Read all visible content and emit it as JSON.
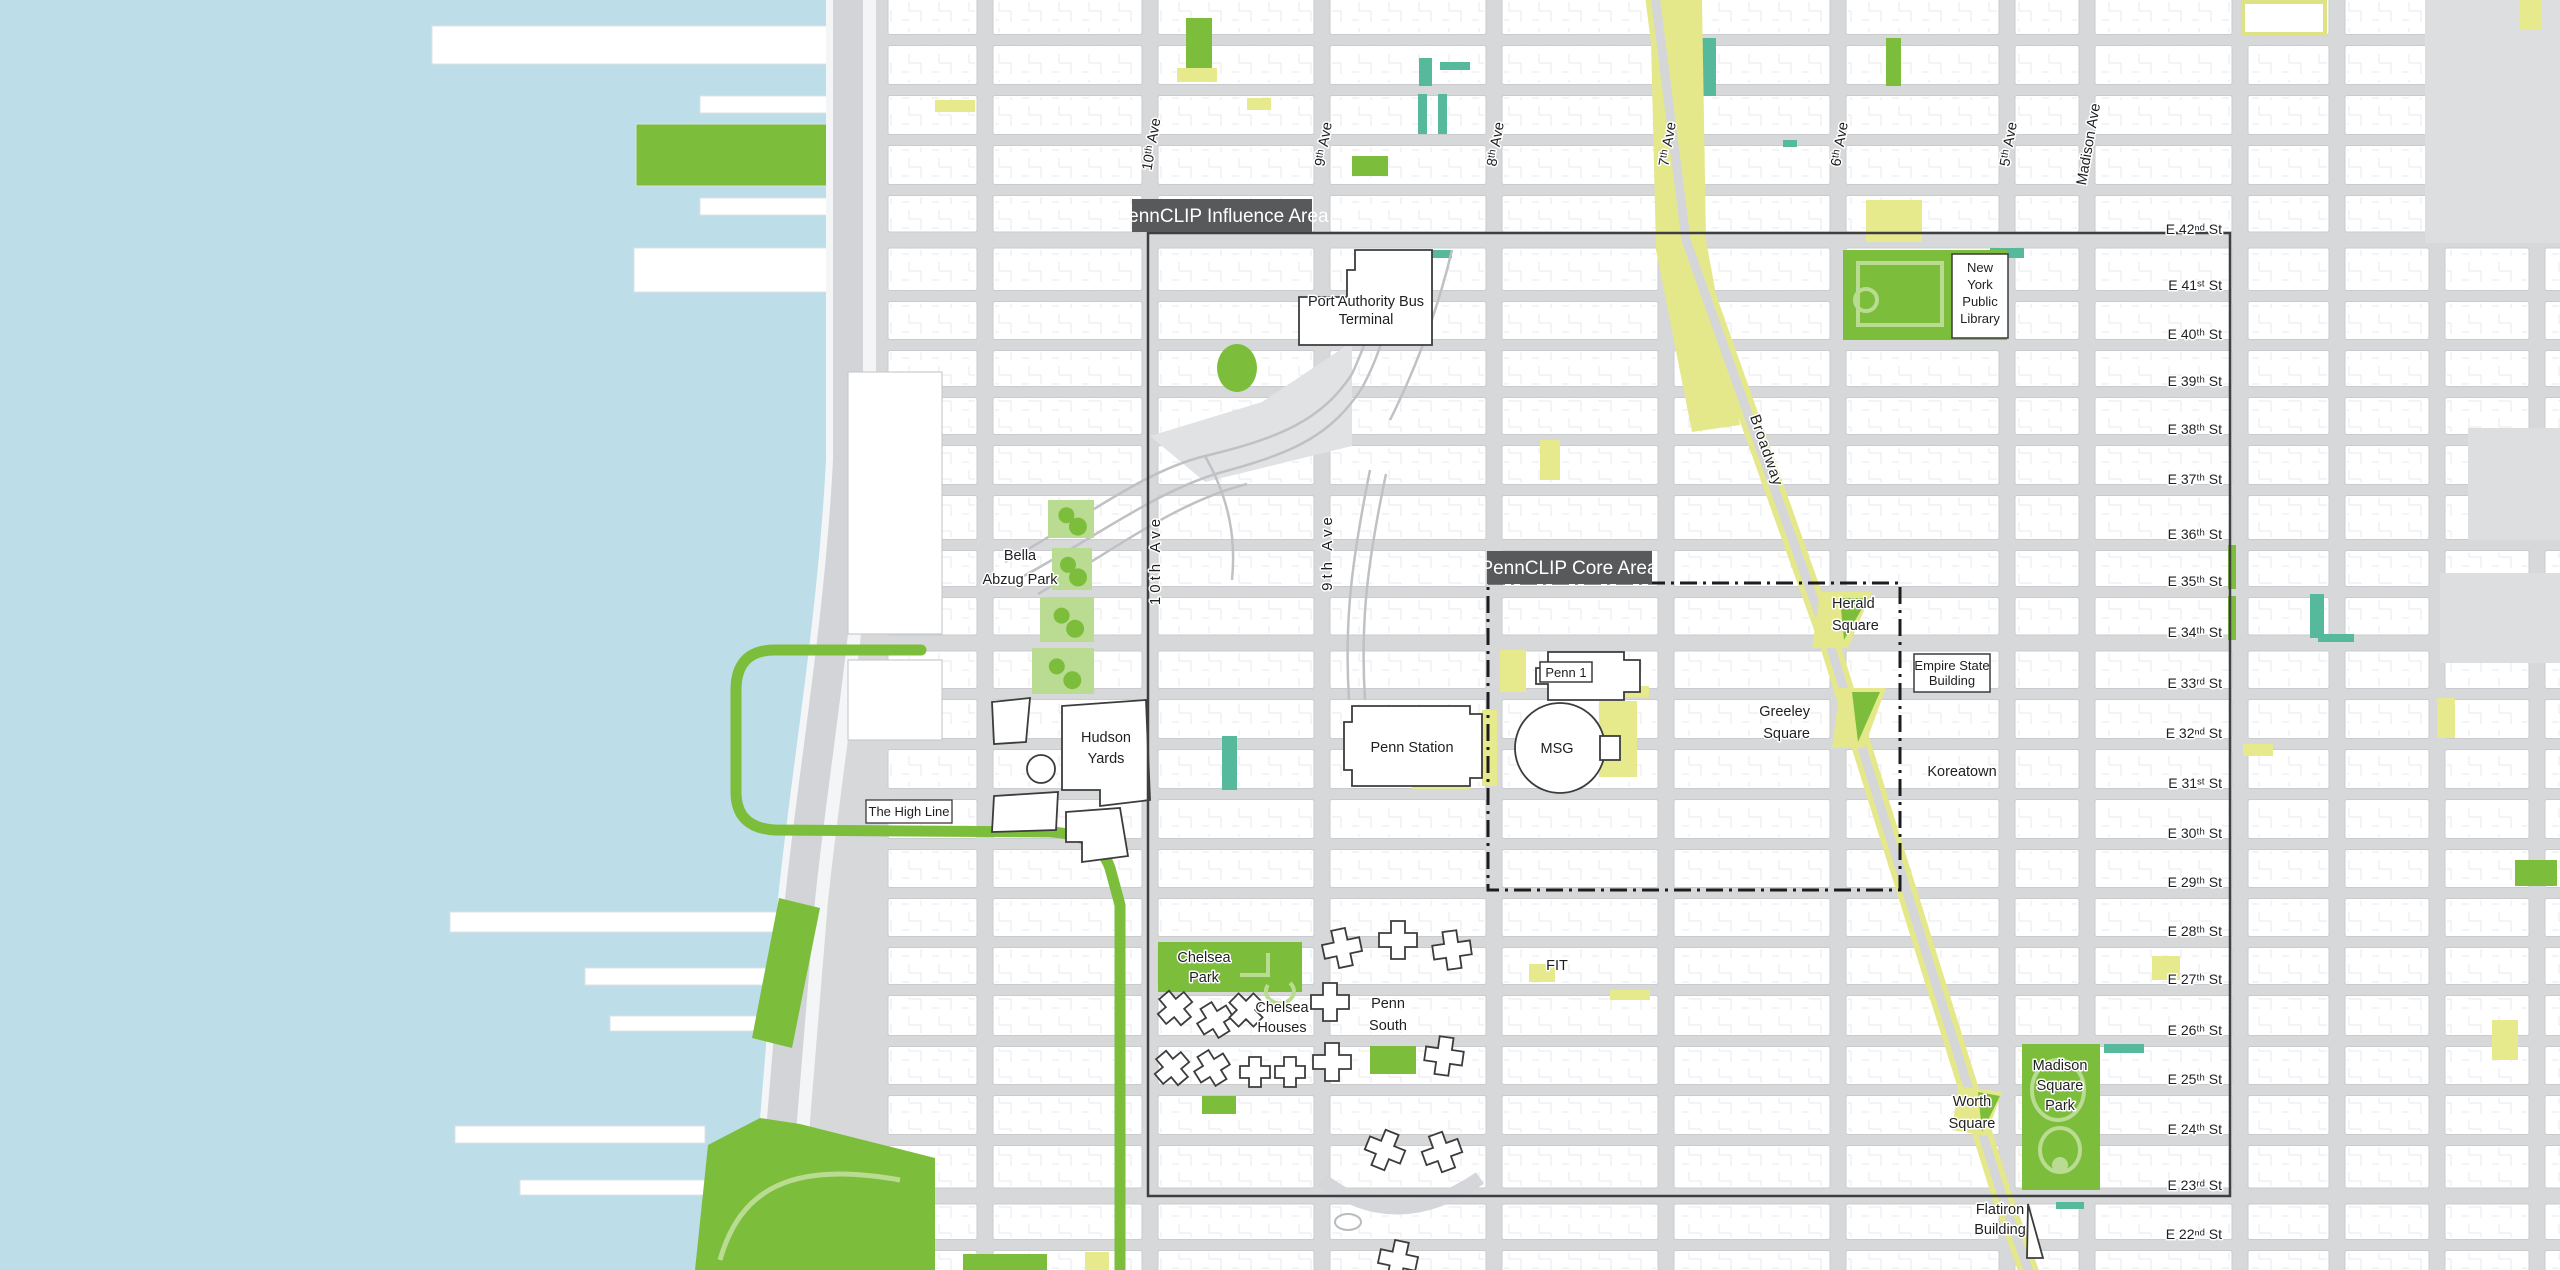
{
  "map": {
    "title": "PennCLIP study area map",
    "region_labels": [
      {
        "id": "influence",
        "text": "PennCLIP Influence Area"
      },
      {
        "id": "core",
        "text": "PennCLIP Core Area"
      }
    ],
    "street_labels": [
      "E 42ⁿᵈ St",
      "E 41ˢᵗ St",
      "E 40ᵗʰ St",
      "E 39ᵗʰ St",
      "E 38ᵗʰ St",
      "E 37ᵗʰ St",
      "E 36ᵗʰ St",
      "E 35ᵗʰ St",
      "E 34ᵗʰ St",
      "E 33ʳᵈ St",
      "E 32ⁿᵈ St",
      "E 31ˢᵗ St",
      "E 30ᵗʰ St",
      "E 29ᵗʰ St",
      "E 28ᵗʰ St",
      "E 27ᵗʰ St",
      "E 26ᵗʰ St",
      "E 25ᵗʰ St",
      "E 24ᵗʰ St",
      "E 23ʳᵈ St",
      "E 22ⁿᵈ St"
    ],
    "avenue_labels": [
      "10ᵗʰ Ave",
      "9ᵗʰ Ave",
      "8ᵗʰ Ave",
      "7ᵗʰ Ave",
      "6ᵗʰ Ave",
      "5ᵗʰ Ave",
      "Madison Ave"
    ],
    "avenue_labels_mid": [
      "10th Ave",
      "9th Ave"
    ],
    "road_labels": [
      "Broadway"
    ],
    "place_labels": [
      {
        "id": "pabt",
        "text": "Port Authority Bus\nTerminal"
      },
      {
        "id": "nypl",
        "text": "New\nYork\nPublic\nLibrary"
      },
      {
        "id": "bella",
        "text": "Bella\nAbzug Park"
      },
      {
        "id": "hudson_yards",
        "text": "Hudson\nYards"
      },
      {
        "id": "highline",
        "text": "The High Line"
      },
      {
        "id": "penn_station",
        "text": "Penn Station"
      },
      {
        "id": "msg",
        "text": "MSG"
      },
      {
        "id": "penn1",
        "text": "Penn 1"
      },
      {
        "id": "herald",
        "text": "Herald\nSquare"
      },
      {
        "id": "greeley",
        "text": "Greeley\nSquare"
      },
      {
        "id": "esb",
        "text": "Empire State\nBuilding"
      },
      {
        "id": "koreatown",
        "text": "Koreatown"
      },
      {
        "id": "chelsea_park",
        "text": "Chelsea\nPark"
      },
      {
        "id": "chelsea_houses",
        "text": "Chelsea\nHouses"
      },
      {
        "id": "penn_south",
        "text": "Penn\nSouth"
      },
      {
        "id": "fit",
        "text": "FIT"
      },
      {
        "id": "msp",
        "text": "Madison\nSquare\nPark"
      },
      {
        "id": "worth",
        "text": "Worth\nSquare"
      },
      {
        "id": "flatiron",
        "text": "Flatiron\nBuilding"
      }
    ],
    "colors": {
      "water": "#bddde9",
      "street": "#d6d8da",
      "block": "#ffffff",
      "park_green": "#7cbe3b",
      "park_light": "#b9dc92",
      "accent_teal": "#56b99c",
      "accent_yellow": "#e6e98c",
      "broadway_yellow": "#e4e88a",
      "boundary_dark": "#3e3f41",
      "region_box": "#58595b"
    }
  }
}
